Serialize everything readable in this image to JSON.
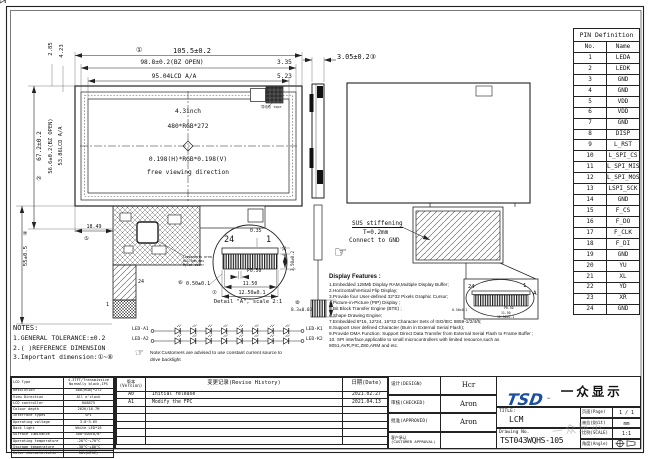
{
  "front": {
    "size": "4.3inch",
    "resolution": "480*RGB*272",
    "dot_pitch": "0.198(H)*RGB*0.198(V)",
    "viewing": "free viewing direction",
    "tape_label": "导电布 tape",
    "fpc": {
      "components_l1": "Components area",
      "components_l2": "H≤1.5mm max",
      "components_l3": "Mylar cover",
      "pin24": "24",
      "pin1": "1"
    }
  },
  "dims": {
    "mark1": "①",
    "total_w": "105.5±0.2",
    "bz_w": "98.8±0.2(BZ OPEN)",
    "r1": "3.35",
    "aa_w": "95.04LCD A/A",
    "r2": "5.23",
    "tl1": "2.85",
    "tl2": "4.23",
    "mark2": "②",
    "total_h": "67.2±0.2",
    "bz_h": "56.6±0.2(BZ OPEN)",
    "aa_h": "53.86LCD A/A",
    "mark4": "④",
    "fpc_len": "55±0.5",
    "mark5": "⑤",
    "fpc_off": "18.49",
    "thickness": "3.05±0.2③",
    "mark8": "⑧",
    "conn_len": "8.3±0.03"
  },
  "detail": {
    "pin24": "24",
    "pin1": "1",
    "d035": "0.35",
    "p050": "P0.50",
    "w1150": "11.50",
    "mark6": "⑥",
    "d050": "0.50±0.1",
    "mark7": "⑦",
    "w1250": "12.50±0.1",
    "t020": "0.20",
    "t350": "3.50±0.2",
    "caption": "Detail \"A\", scale 2:1"
  },
  "rear": {
    "sus_l1": "SUS stiffening",
    "sus_l2": "T=0.2mm",
    "sus_l3": "Connect to GND",
    "pin24": "24",
    "pin1": "1",
    "callout_a": "A",
    "hand": "☞"
  },
  "led": {
    "a1": "LED-A1",
    "a2": "LED-A2",
    "k1": "LED-K1",
    "k2": "LED-K2",
    "hand": "☞",
    "note_l1": "Note:Customers are advised to use constant current source to",
    "note_l2": "drive backlight"
  },
  "features": {
    "title": "Display Features :",
    "items": [
      "1.Embedded 128Mb Display RAM,Multiple Display Buffer;",
      "2.Horizontal/Vertical Flip Display;",
      "3.Provide four User-defined 32*32 Pixels Graphic Cursor;",
      "4.Picture-in-Picture (PIP) Display ;",
      "5.Bit Block Transfer Engine (BTE) ;",
      "6.Shape Drawing Engine;",
      "7.Embedded 8*16, 12*24, 16*32 Character Sets of ISO/IEC 8859-1/2/4/5;",
      "8.Support User defined Character (Burn in External Serial Flash);",
      "9.Provide DMA Function: Support Direct Data Transfer from External Serial Flash to Frame Buffer ;",
      "10. SPI interface,applicable to small microcontrollers with limited resource,such as 8051,AVR,PIC,Z80,ARM and etc."
    ]
  },
  "notes": {
    "title": "NOTES:",
    "items": [
      "1.GENERAL TOLERANCE:±0.2",
      "2.( )REFERENCE DIMENSION",
      "3.Important dimension:①~⑧"
    ]
  },
  "pin_table": {
    "title": "PIN Definition",
    "col_no": "No.",
    "col_name": "Name",
    "rows": [
      [
        "1",
        "LEDA"
      ],
      [
        "2",
        "LEDK"
      ],
      [
        "3",
        "GND"
      ],
      [
        "4",
        "GND"
      ],
      [
        "5",
        "VDD"
      ],
      [
        "6",
        "VDD"
      ],
      [
        "7",
        "GND"
      ],
      [
        "8",
        "DISP"
      ],
      [
        "9",
        "L_RST"
      ],
      [
        "10",
        "L_SPI_CS"
      ],
      [
        "11",
        "L_SPI_MISO"
      ],
      [
        "12",
        "L_SPI_MOSI"
      ],
      [
        "13",
        "LSPI_SCK"
      ],
      [
        "14",
        "GND"
      ],
      [
        "15",
        "F_CS"
      ],
      [
        "16",
        "F_DO"
      ],
      [
        "17",
        "F_CLK"
      ],
      [
        "18",
        "F_DI"
      ],
      [
        "19",
        "GND"
      ],
      [
        "20",
        "YU"
      ],
      [
        "21",
        "XL"
      ],
      [
        "22",
        "YD"
      ],
      [
        "23",
        "XR"
      ],
      [
        "24",
        "GND"
      ]
    ]
  },
  "spec_table": {
    "rows": [
      [
        "LCD Type",
        "4.3TFT/Transmissive\nNormally black,IPS"
      ],
      [
        "Resolution",
        "480(RGB)*272"
      ],
      [
        "View Direction",
        "All o'clock"
      ],
      [
        "LCD controller",
        "RA8875"
      ],
      [
        "Colour depth",
        "262K/16.7M"
      ],
      [
        "Interface types",
        "SPI"
      ],
      [
        "Operating voltage",
        "3.0~3.6V"
      ],
      [
        "Back light",
        "White LED*16"
      ],
      [
        "Surface luminance",
        "300~500cd/m²"
      ],
      [
        "Operating temperature",
        "-20°C~+70°C"
      ],
      [
        "Storage temperature",
        "-30°C~+80°C"
      ],
      [
        "Color characteristic",
        "50%(NTSC)"
      ]
    ]
  },
  "revision": {
    "h_version": "版本\n(Version)",
    "h_history": "变更记录(Revise History)",
    "h_date": "日期(Date)",
    "rows": [
      [
        "A0",
        "Initial release",
        "2021.02.27"
      ],
      [
        "A1",
        "Modify the FPC",
        "2021.04.13"
      ]
    ],
    "empty_rows": 5
  },
  "title_block": {
    "design_label": "设计(DESIGN)",
    "design": "Hcr",
    "checked_label": "审核(CHECKED)",
    "checked": "Aron",
    "approved_label": "批准(APPROVED)",
    "approved": "Aron",
    "customer_label": "客户承认\n(CUSTOMER APPROVAL)",
    "customer": "",
    "logo_tsd": "TSD",
    "logo_tm": "™",
    "logo_cn": "一众显示",
    "logo_en": "TEAM SOURCE DISPLAY",
    "title_label": "TITLE:",
    "title_value": "LCM",
    "drawing_label": "Drawing No.",
    "drawing_no": "TST043WQHS-105",
    "page_label": "页面(Page)",
    "page": "1 / 1",
    "unit_label": "单位(Unit)",
    "unit": "mm",
    "scale_label": "比例(SCALE)",
    "scale": "1:1",
    "angle_label": "角度(Angle)"
  },
  "watermark": "一众显示"
}
